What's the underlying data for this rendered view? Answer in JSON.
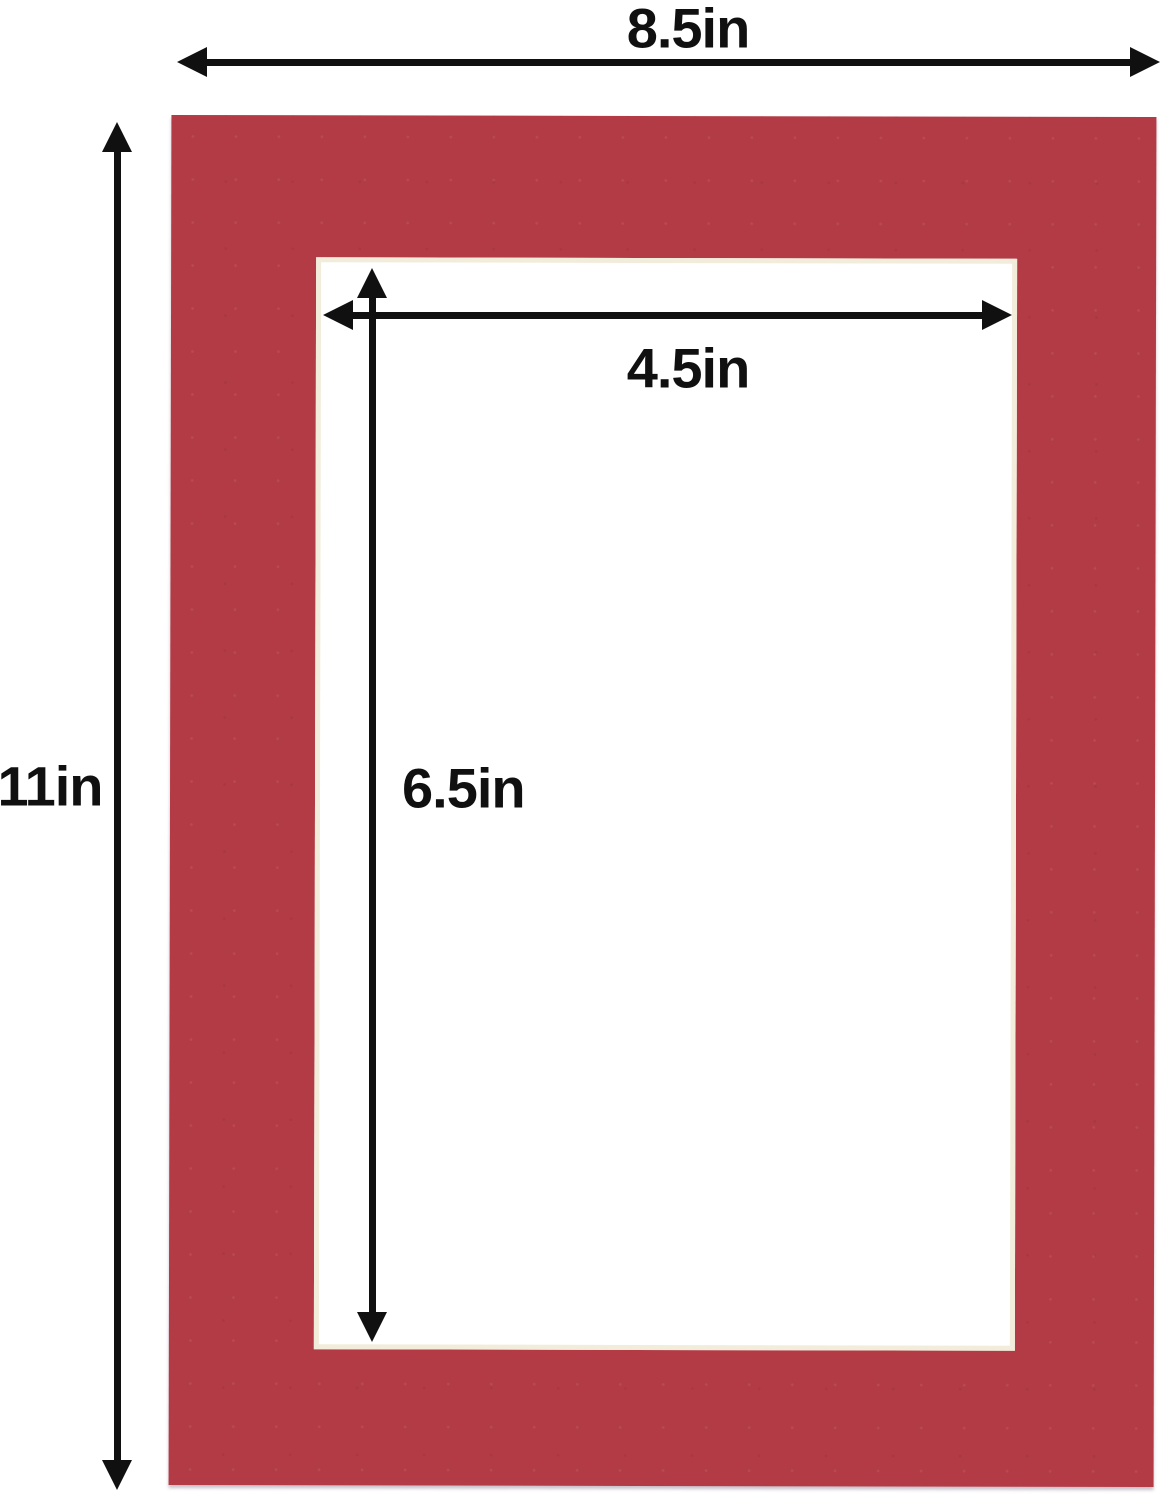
{
  "diagram": {
    "labels": {
      "outer_width": "8.5in",
      "outer_height": "11in",
      "opening_width": "4.5in",
      "opening_height": "6.5in"
    }
  },
  "colors": {
    "mat_red": "#b23b46",
    "arrow": "#101010",
    "bevel": "#f2ecdb",
    "background": "#ffffff"
  }
}
